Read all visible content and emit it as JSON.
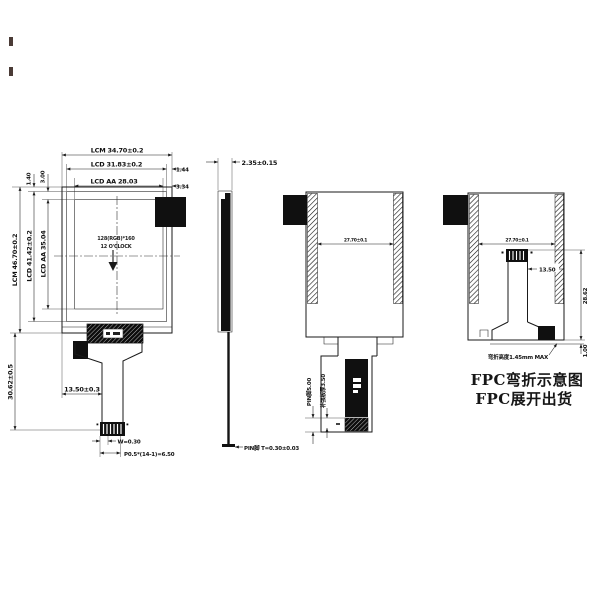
{
  "front": {
    "lcm_w": "LCM 34.70±0.2",
    "lcd_w": "LCD 31.83±0.2",
    "lcd_w_off": "1.44",
    "aa_w": "LCD AA 28.03",
    "aa_w_off": "3.34",
    "lcm_h": "LCM 46.70±0.2",
    "lcd_h": "LCD 41.42±0.2",
    "aa_h": "LCD AA 35.04",
    "off_top1": "1.40",
    "off_top2": "3.00",
    "fpc_len": "30.62±0.5",
    "resolution": "128(RGB)*160",
    "clock": "12 O'CLOCK",
    "tail_w": "13.50±0.3",
    "pin_w": "W=0.30",
    "pin_pitch": "P0.5*(14-1)=6.50"
  },
  "side": {
    "thickness": "2.35±0.15",
    "pin_t": "PIN脚 T=0.30±0.03"
  },
  "unfolded": {
    "tape_gap": "27.70±0.1",
    "stiffener": "补强板厚3.50",
    "pin_len": "PIN脚5.00"
  },
  "folded": {
    "tape_gap": "27.70±0.1",
    "tail_w": "13.50",
    "height": "28.62",
    "gap": "1.00",
    "bend_note": "弯折高度1.45mm MAX"
  },
  "captions": {
    "folded": "FPC弯折示意图",
    "unfolded": "FPC展开出货"
  }
}
